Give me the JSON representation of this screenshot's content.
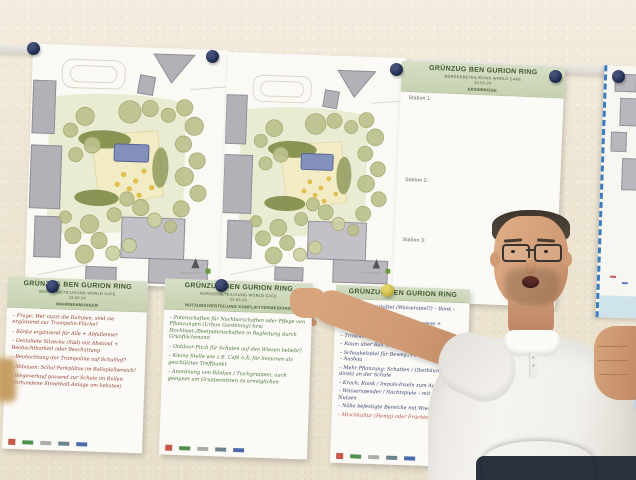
{
  "colors": {
    "wall": "#efe7d5",
    "pin_navy": "#233052",
    "pin_olive": "#c9b544",
    "header_green_bg": "#cdd8bb",
    "header_green_text": "#445930",
    "ink_red": "#8f3a31",
    "ink_green": "#46703c",
    "ink_blue": "#2e3d6e",
    "map_dash_blue": "#3a7cc0"
  },
  "poster_header": {
    "title": "GRÜNZUG BEN GURION RING",
    "subtitle": "BÜRGERBETEILIGUNG WORLD CAFE",
    "date": "23.03.24"
  },
  "results_poster": {
    "tag": "ERGEBNISSE",
    "stations": [
      "Station 1:",
      "Station 2:",
      "Station 3:"
    ]
  },
  "poster_a": {
    "tag": "WAHRNEHMUNGEN",
    "items": [
      "– Frage: Wer nutzt die Rampen, sind sie ergänzend zur Trampolin-Fläche?",
      "– Bänke ergänzend für Alle + Abfalleimer",
      "– Gestaltete Sitzecke (Süd) mit Abstand + Beobachtbarkeit oder Beschattung",
      "– Beobachtung der Trampoline auf Schulhof?",
      "– Abbauen: Schul-Parkplätze im Ballspielbereich!",
      "– Wegeverlauf passend zur Schule im Rollen (Vorhandene Streetball-Anlage am liebsten)"
    ]
  },
  "poster_b": {
    "tag": "NUTZUNG/VERTEILUNG KONFLIKTVERMEIDUNG",
    "items": [
      "– Patenschaften für Nachbarschaften oder Pflege von Pflanzungen (Urban Gardening) bzw. Hochbeet-/Beetpatenschaften in Begleitung durch Grünflächenamt",
      "– Outdoor-Pitch für Schulen auf den Wiesen beliebt?",
      "– Kleine Stelle wie z.B. Café o.Ä. für Senioren als geschützter Treffpunkt",
      "– Anordnung von Bänken / Tischgruppen, auch geeignet um Gruppensitzen zu ermöglichen"
    ]
  },
  "poster_c": {
    "items": [
      "– Sitzplätze gestaltet (Wasserspiel?) – Bank – Tisch – Klang",
      "– Platz für mobile Aktion! Liegewiese + Fahrzeuge ca. 4×6 m",
      "– Trinkwasserspender",
      "– Raum über Ball angefragt",
      "– Schaukelspiel für Beweg./Vibrations-Elemente – Ausbau",
      "– Mehr Pflanzung: Schatten / Obstbäume, z.T. direkt an der Schule",
      "– Krach: Kiosk / Impuls-Inseln zum Austausch",
      "– Wasserspender / Nachtspiele – mit Blick zum Nutzen",
      "– Nähe befestigte Bereiche mit Wiesen",
      "– Mischkultur (Honig) oder Früchte: Apfel"
    ]
  }
}
